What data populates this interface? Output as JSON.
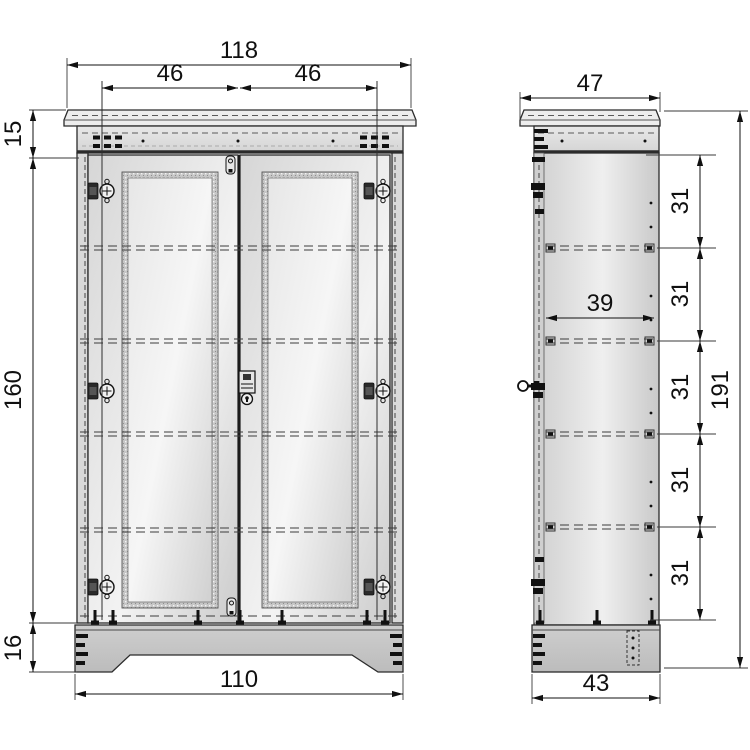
{
  "front_view": {
    "dims": {
      "total_width": "118",
      "left_door_width": "46",
      "right_door_width": "46",
      "cornice_height": "15",
      "carcass_height": "160",
      "plinth_height": "16",
      "plinth_width": "110"
    }
  },
  "side_view": {
    "dims": {
      "top_depth": "47",
      "interior_depth": "39",
      "shelf_spacings": [
        "31",
        "31",
        "31",
        "31",
        "31"
      ],
      "total_height": "191",
      "plinth_depth": "43"
    }
  },
  "colors": {
    "background": "#ffffff",
    "outline": "#2b2b2b",
    "dimension": "#101010",
    "fill_light": "#ededed",
    "fill_mid": "#d9d9d9",
    "fill_dark": "#c3c3c3"
  }
}
